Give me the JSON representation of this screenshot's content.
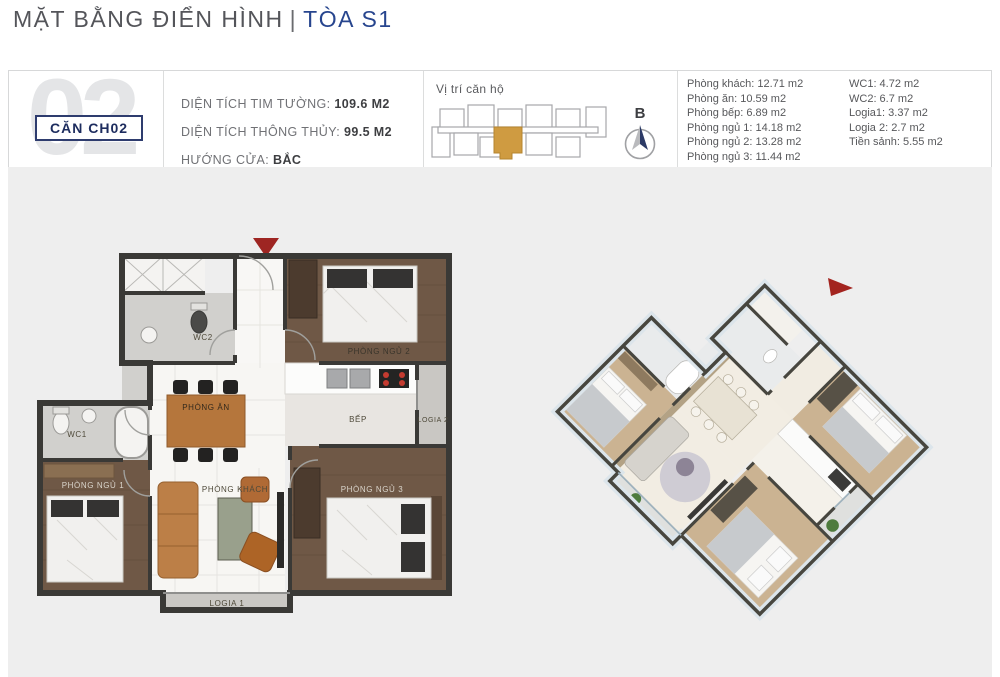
{
  "title": {
    "main": "MẶT BẰNG ĐIỂN HÌNH",
    "separator": "|",
    "highlight": "TÒA S1"
  },
  "unit": {
    "big_number": "02",
    "badge": "CĂN CH02"
  },
  "specs": [
    {
      "label": "DIỆN TÍCH TIM TƯỜNG: ",
      "value": "109.6 M2"
    },
    {
      "label": "DIỆN TÍCH THÔNG THỦY: ",
      "value": "99.5 M2"
    },
    {
      "label": "HƯỚNG CỬA: ",
      "value": "BẮC"
    }
  ],
  "location": {
    "title": "Vị trí căn hộ",
    "compass": "B"
  },
  "areas_col1": [
    "Phòng khách: 12.71 m2",
    "Phòng ăn: 10.59 m2",
    "Phòng bếp: 6.89 m2",
    "Phòng ngủ 1: 14.18 m2",
    "Phòng ngủ 2: 13.28 m2",
    "Phòng ngủ 3: 11.44 m2"
  ],
  "areas_col2": [
    "WC1: 4.72 m2",
    "WC2: 6.7 m2",
    "Logia1: 3.37 m2",
    "Logia 2: 2.7 m2",
    "Tiền sảnh: 5.55 m2"
  ],
  "floorplan": {
    "labels": {
      "wc1": "WC1",
      "wc2": "WC2",
      "bedroom1": "PHÒNG NGỦ 1",
      "bedroom2": "PHÒNG NGỦ 2",
      "bedroom3": "PHÒNG NGỦ 3",
      "dining": "PHÒNG ĂN",
      "kitchen": "BẾP",
      "living": "PHÒNG KHÁCH",
      "logia1": "LOGIA 1",
      "logia2": "LOGIA 2"
    }
  },
  "colors": {
    "accent_blue": "#27458e",
    "badge_navy": "#1d2c5e",
    "highlight_gold": "#cf9b41",
    "entry_marker_red": "#9e2522",
    "panel_grey": "#eeeeee"
  }
}
